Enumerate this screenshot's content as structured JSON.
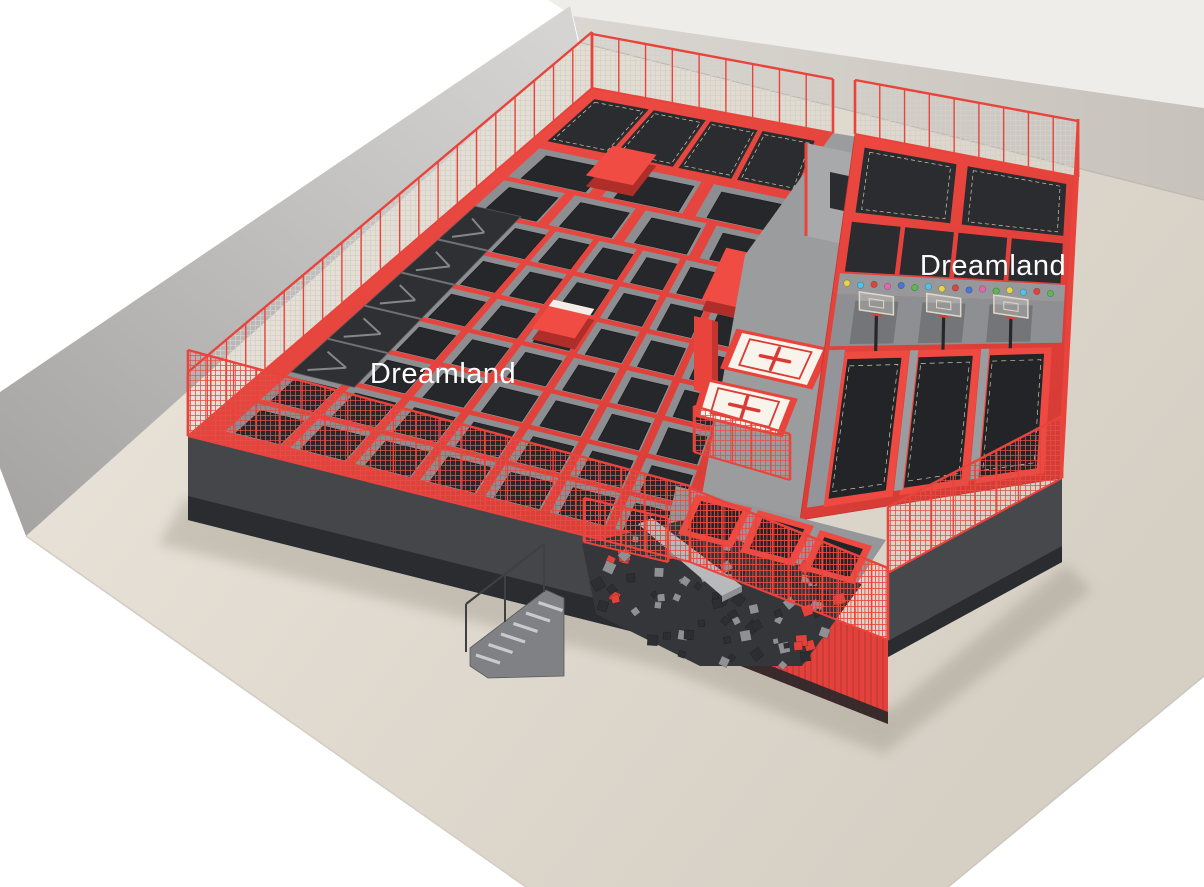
{
  "labels": {
    "title_left": "Dreamland",
    "title_right": "Dreamland"
  },
  "palette": {
    "red": "#e8443c",
    "red_bright": "#f04c43",
    "red_deep": "#c23530",
    "red_frame": "#ee4a42",
    "bed_dark": "#26272a",
    "bed_dark2": "#232428",
    "panel_dark": "#2b2c30",
    "frame_gray": "#8d8e91",
    "walk_gray": "#9b9c9e",
    "ledge_gray": "#97989b",
    "wall_band_gray": "#8e8f92",
    "face_dark": "#45464a",
    "face_dark2": "#47484c",
    "base_dark": "#2b2c2f",
    "foam_bg": "#35363a",
    "foam_cube_dark": "#2d2e32",
    "foam_cube_gray": "#8f9093",
    "pad_white": "#f8f4ec",
    "cross_red": "#d93a34",
    "backboard": "#ded8c8",
    "post_dark": "#26272a",
    "beam_gray": "#b8b9bb",
    "mesh_light": "#d4d1ca",
    "mesh_red": "#e25048",
    "floor_light": "#ece6dc",
    "floor_dark": "#d5cfc4",
    "wall_light": "#d6d4d2",
    "wall_shade": "#a5a3a2",
    "wall_top_light": "#dad6d1",
    "wall_top_dark": "#c7c2bb",
    "dashed_trim": "#cfc9ae",
    "white": "#ffffff"
  },
  "balls": {
    "count": 16,
    "colors": [
      "#e9d44a",
      "#4fc3e8",
      "#e0433c",
      "#e565b5",
      "#4976d6",
      "#5cb850",
      "#4fc3e8",
      "#e9d44a",
      "#e0433c",
      "#4976d6",
      "#e565b5",
      "#5cb850",
      "#e9d44a",
      "#4fc3e8",
      "#e0433c",
      "#5cb850"
    ]
  },
  "counts": {
    "main_grid_rows": 9,
    "main_grid_cols": 7,
    "back_wall_trampolines": 4,
    "right_back_trampolines": 2,
    "right_vertical_trampolines": 4,
    "basketball_hoops": 3,
    "dunk_lanes": 3,
    "airbag_pads": 2,
    "small_trampolines": 3,
    "foam_cubes": 85,
    "stair_steps": 6,
    "fence_segments": 9
  }
}
